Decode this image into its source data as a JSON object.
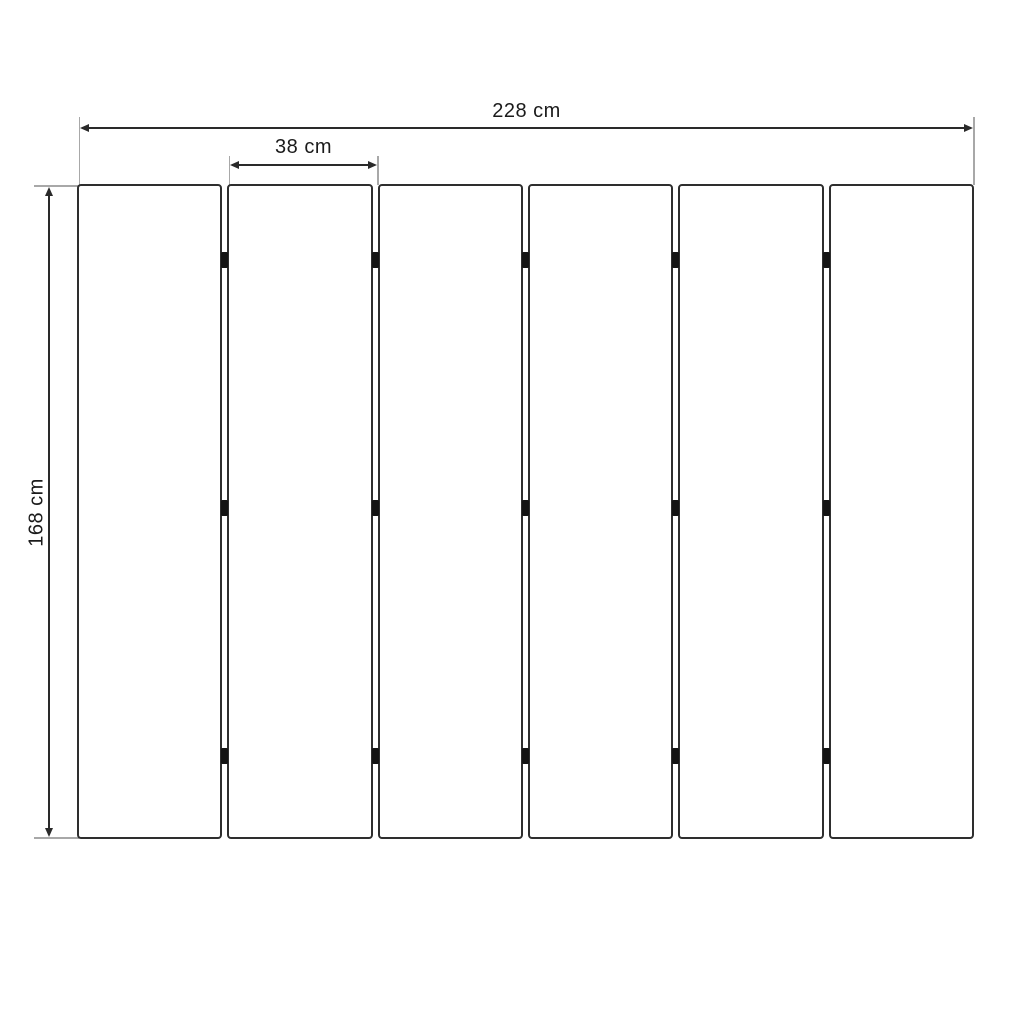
{
  "diagram": {
    "type": "technical-dimension-drawing",
    "subject": "six vertical panels connected by small hinge blocks",
    "labels": {
      "total_width": "228 cm",
      "single_panel_width": "38 cm",
      "panel_height": "168 cm"
    },
    "panels": {
      "count": 6,
      "gaps": 5,
      "connectors_per_gap": 3
    },
    "colors": {
      "background": "#ffffff",
      "panel_outline": "#2e2e2e",
      "dimension_line": "#2a2a2a",
      "extension_line": "#a8a8a8",
      "connector": "#141414",
      "label_text": "#1b1b1b"
    }
  }
}
